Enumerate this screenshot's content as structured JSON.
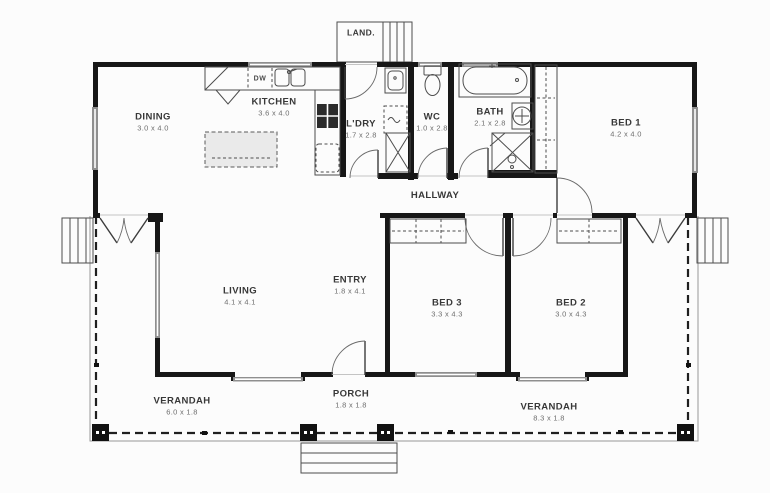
{
  "meta": {
    "drawing_type": "residential floor plan",
    "colors": {
      "background": "#fcfcfc",
      "wall": "#171717",
      "line": "#4d4d4d",
      "window": "#8f8f8f",
      "label": "#383838",
      "dim_text": "#6e6e6e",
      "dash": "#1f1f1f",
      "edge": "#999999"
    }
  },
  "rooms": [
    {
      "id": "land",
      "name": "LAND.",
      "dims": ""
    },
    {
      "id": "dining",
      "name": "DINING",
      "dims": "3.0 x 4.0"
    },
    {
      "id": "kitchen",
      "name": "KITCHEN",
      "dims": "3.6 x 4.0"
    },
    {
      "id": "ldry",
      "name": "L'DRY",
      "dims": "1.7 x 2.8"
    },
    {
      "id": "wc",
      "name": "WC",
      "dims": "1.0 x 2.8"
    },
    {
      "id": "bath",
      "name": "BATH",
      "dims": "2.1 x 2.8"
    },
    {
      "id": "bed1",
      "name": "BED 1",
      "dims": "4.2 x 4.0"
    },
    {
      "id": "hallway",
      "name": "HALLWAY",
      "dims": ""
    },
    {
      "id": "living",
      "name": "LIVING",
      "dims": "4.1 x 4.1"
    },
    {
      "id": "entry",
      "name": "ENTRY",
      "dims": "1.8 x 4.1"
    },
    {
      "id": "bed3",
      "name": "BED 3",
      "dims": "3.3 x 4.3"
    },
    {
      "id": "bed2",
      "name": "BED 2",
      "dims": "3.0 x 4.3"
    },
    {
      "id": "verandah_left",
      "name": "VERANDAH",
      "dims": "6.0 x 1.8"
    },
    {
      "id": "porch",
      "name": "PORCH",
      "dims": "1.8 x 1.8"
    },
    {
      "id": "verandah_right",
      "name": "VERANDAH",
      "dims": "8.3 x 1.8"
    }
  ],
  "fixtures": {
    "dishwasher_label": "DW"
  }
}
